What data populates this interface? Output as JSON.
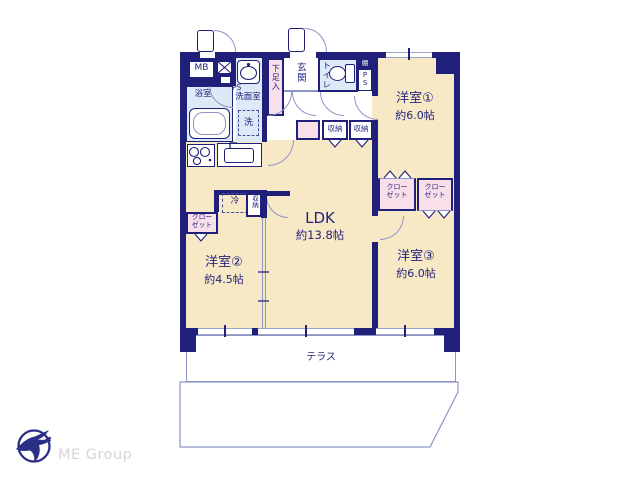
{
  "plan": {
    "rooms": {
      "ldk": {
        "name": "LDK",
        "area": "約13.8帖"
      },
      "western1": {
        "name": "洋室①",
        "area": "約6.0帖"
      },
      "western2": {
        "name": "洋室②",
        "area": "約4.5帖"
      },
      "western3": {
        "name": "洋室③",
        "area": "約6.0帖"
      },
      "bathroom": {
        "name": "浴室"
      },
      "washroom": {
        "name": "洗面室"
      },
      "toilet": {
        "name": "トイレ"
      },
      "entrance": {
        "name": "玄関"
      }
    },
    "features": {
      "meter_box": "MB",
      "pipe_space": "PS",
      "shelf": "棚",
      "shoe_cabinet": "下足入",
      "washer_space": "洗",
      "refrigerator_space": "冷",
      "storage": "収納",
      "closet": "クローゼット",
      "terrace": "テラス",
      "private_garden": "専用庭"
    }
  },
  "branding": {
    "company": "ME Group"
  },
  "colors": {
    "wall_navy": "#20207a",
    "room_cream": "#f7e8c6",
    "wet_area_blue": "#dce9f6",
    "closet_pink": "#f9dfe9",
    "fixture_line": "#8d94c6",
    "label_text": "#23237c",
    "logo_navy": "#2b2f85",
    "logo_text_gray": "#d6d6d6"
  }
}
